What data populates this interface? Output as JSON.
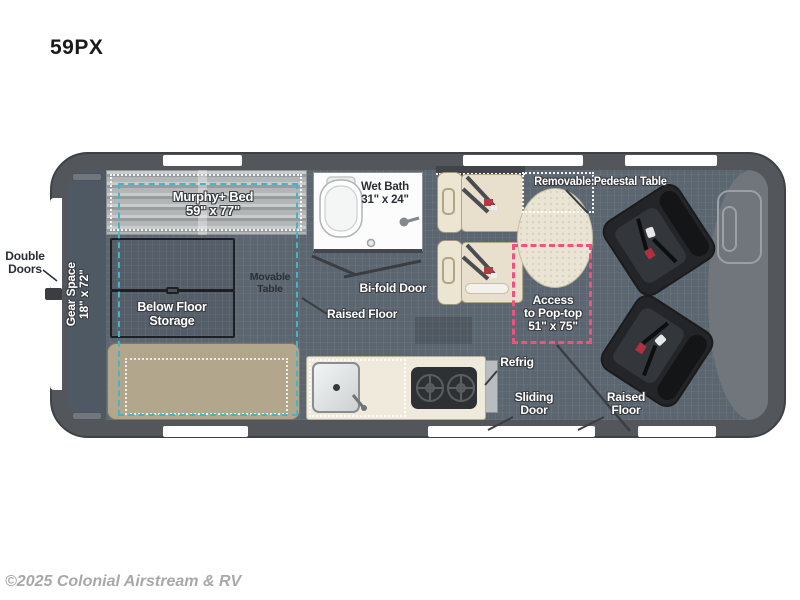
{
  "title": {
    "model_code": "59PX"
  },
  "watermark": {
    "text": "©2025 Colonial Airstream & RV"
  },
  "labels": {
    "double_doors": {
      "line1": "Double",
      "line2": "Doors"
    },
    "gear_space": {
      "line1": "Gear Space",
      "line2": "18\" x 72\""
    },
    "murphy_bed": {
      "line1": "Murphy+ Bed",
      "line2": "59\" x 77\""
    },
    "below_floor_storage": {
      "line1": "Below Floor",
      "line2": "Storage"
    },
    "movable_table": {
      "line1": "Movable",
      "line2": "Table"
    },
    "wet_bath": {
      "line1": "Wet Bath",
      "line2": "31\" x 24\""
    },
    "bifold_door": {
      "text": "Bi-fold Door"
    },
    "raised_floor_mid": {
      "text": "Raised Floor"
    },
    "removable_pedestal_table": {
      "text": "Removable Pedestal Table"
    },
    "access_pop_top": {
      "line1": "Access",
      "line2": "to Pop-top",
      "line3": "51\" x 75\""
    },
    "refrig": {
      "text": "Refrig"
    },
    "sliding_door": {
      "line1": "Sliding",
      "line2": "Door"
    },
    "raised_floor_right": {
      "line1": "Raised",
      "line2": "Floor"
    }
  },
  "colors": {
    "accent_pink": "#f0517f",
    "accent_cyan": "#3fb7c9",
    "van_border": "#53565b",
    "floor": "#5c6670",
    "bed_silver": "#b4b7b8",
    "bench_tan": "#b2a68c",
    "seat_beige": "#ece5d2",
    "table_cream": "#e9e4d3",
    "swivel_seat_dark": "#232528"
  }
}
